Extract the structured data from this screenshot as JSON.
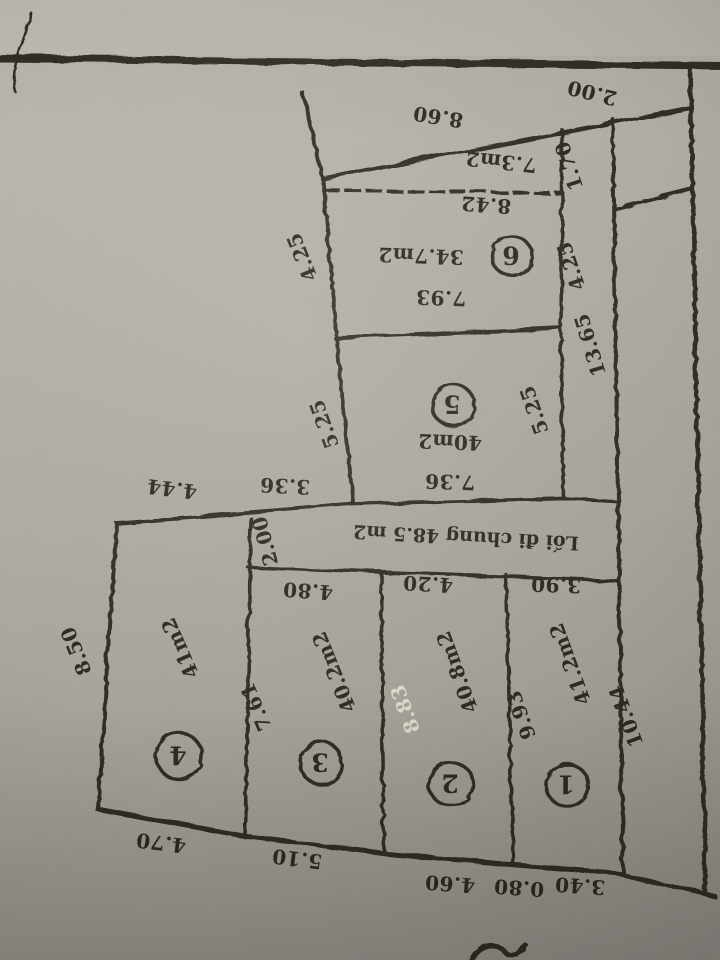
{
  "plan": {
    "common_path_label": "Lối đi chung 48.5 m2",
    "parcels": [
      {
        "no": "1",
        "area": "41.2m2"
      },
      {
        "no": "2",
        "area": "40.8m2"
      },
      {
        "no": "3",
        "area": "40.2m2"
      },
      {
        "no": "4",
        "area": "41m2"
      },
      {
        "no": "5",
        "area": "40m2"
      },
      {
        "no": "6",
        "area": "34.7m2"
      }
    ],
    "small_triangle_area": "7.3m2",
    "dims": {
      "top_860": "8.60",
      "top_200": "2.00",
      "t_170": "1.70",
      "t_842": "8.42",
      "left_425": "4.25",
      "right_425": "4.25",
      "p6_793": "7.93",
      "col_1365": "13.65",
      "p5_left_525": "5.25",
      "p5_right_525": "5.25",
      "p5_736": "7.36",
      "notch_336": "3.36",
      "notch_444": "4.44",
      "path_200": "2.00",
      "w1_390": "3.90",
      "w2_420": "4.20",
      "w3_480": "4.80",
      "s4_850": "8.50",
      "s3_761": "7.61",
      "s2_883": "8.83",
      "s1_993": "9.93",
      "edge_1044": "10.44",
      "b4_470": "4.70",
      "b3_510": "5.10",
      "b2_460": "4.60",
      "b1_080": "0.80",
      "b0_340": "3.40"
    }
  },
  "colors": {
    "paper": "#aeaaa2",
    "ink": "#2f2a23",
    "white_ink": "#dcd7c9",
    "edge_band": "#211d17"
  },
  "orientation_note": "photo is upside down (rotated 180°)"
}
